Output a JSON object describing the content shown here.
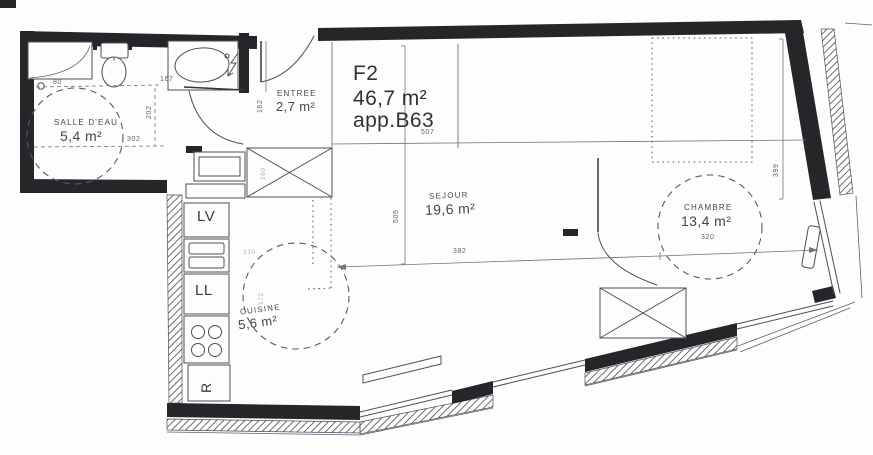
{
  "plan": {
    "title": {
      "type": "F2",
      "area": "46,7 m²",
      "apartment": "app.B63"
    },
    "rooms": {
      "salle_deau": {
        "name": "SALLE D'EAU",
        "area": "5,4 m²"
      },
      "entree": {
        "name": "ENTREE",
        "area": "2,7 m²"
      },
      "sejour": {
        "name": "SEJOUR",
        "area": "19,6 m²"
      },
      "chambre": {
        "name": "CHAMBRE",
        "area": "13,4 m²"
      },
      "cuisine": {
        "name": "CUISINE",
        "area": "5,6 m²"
      }
    },
    "appliances": {
      "dishwasher": "LV",
      "washer": "LL",
      "fridge": "R"
    },
    "dims": {
      "d80": "80",
      "d167": "167",
      "d202": "202",
      "d302": "302",
      "d162": "162",
      "d507": "507",
      "d505": "505",
      "d382": "382",
      "d399": "399",
      "d320": "320",
      "d210": "210",
      "d172": "172",
      "d160": "160"
    },
    "colors": {
      "wall": "#26262a",
      "line": "#4b5058",
      "dim_text": "#5d626a",
      "paper": "#fdfdfc"
    }
  }
}
